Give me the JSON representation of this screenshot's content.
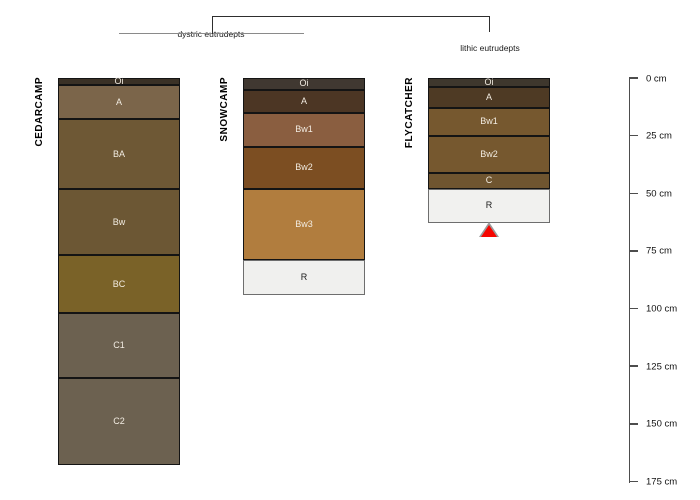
{
  "chart_data": {
    "type": "soil-profile-dendrogram-plot",
    "depth_unit": "cm",
    "depth_axis": {
      "ticks": [
        0,
        25,
        50,
        75,
        100,
        125,
        150,
        175
      ],
      "unit_suffix": " cm",
      "max_depth": 175,
      "position": "right"
    },
    "dendrogram": {
      "groups": [
        {
          "label": "dystric eutrudepts",
          "members": [
            0,
            1
          ]
        },
        {
          "label": "lithic eutrudepts",
          "members": [
            2
          ]
        }
      ]
    },
    "profiles": [
      {
        "name": "CEDARCAMP",
        "group": "dystric eutrudepts",
        "horizons": [
          {
            "name": "Oi",
            "top": 0,
            "bottom": 3,
            "color": "#3a3126"
          },
          {
            "name": "A",
            "top": 3,
            "bottom": 18,
            "color": "#7b654a"
          },
          {
            "name": "BA",
            "top": 18,
            "bottom": 48,
            "color": "#6e5835"
          },
          {
            "name": "Bw",
            "top": 48,
            "bottom": 77,
            "color": "#6c5734"
          },
          {
            "name": "BC",
            "top": 77,
            "bottom": 102,
            "color": "#7a6228"
          },
          {
            "name": "C1",
            "top": 102,
            "bottom": 130,
            "color": "#6c6150"
          },
          {
            "name": "C2",
            "top": 130,
            "bottom": 168,
            "color": "#6c6150"
          }
        ]
      },
      {
        "name": "SNOWCAMP",
        "group": "dystric eutrudepts",
        "horizons": [
          {
            "name": "Oi",
            "top": 0,
            "bottom": 5,
            "color": "#403831"
          },
          {
            "name": "A",
            "top": 5,
            "bottom": 15,
            "color": "#4c3624"
          },
          {
            "name": "Bw1",
            "top": 15,
            "bottom": 30,
            "color": "#8a5e40"
          },
          {
            "name": "Bw2",
            "top": 30,
            "bottom": 48,
            "color": "#7c4e22"
          },
          {
            "name": "Bw3",
            "top": 48,
            "bottom": 79,
            "color": "#b17d3e"
          },
          {
            "name": "R",
            "top": 79,
            "bottom": 94,
            "color": "#f0f0ee"
          }
        ]
      },
      {
        "name": "FLYCATCHER",
        "group": "lithic eutrudepts",
        "horizons": [
          {
            "name": "Oi",
            "top": 0,
            "bottom": 4,
            "color": "#3e372d"
          },
          {
            "name": "A",
            "top": 4,
            "bottom": 13,
            "color": "#4e3a24"
          },
          {
            "name": "Bw1",
            "top": 13,
            "bottom": 25,
            "color": "#76582f"
          },
          {
            "name": "Bw2",
            "top": 25,
            "bottom": 41,
            "color": "#76582f"
          },
          {
            "name": "C",
            "top": 41,
            "bottom": 48,
            "color": "#6f5530"
          },
          {
            "name": "R",
            "top": 48,
            "bottom": 63,
            "color": "#f1f1ef"
          }
        ],
        "marker": {
          "type": "red-triangle",
          "depth": 63,
          "color": "#f60500"
        }
      }
    ],
    "colors": {
      "horizon_border": "#141414",
      "r_horizon_border": "#6e6e6e",
      "axis": "#4d4d4d",
      "dendrogram_leaf_line": "#8a8a8a",
      "dendrogram_root_line": "#2e2e2e",
      "marker_red": "#f60500"
    }
  }
}
